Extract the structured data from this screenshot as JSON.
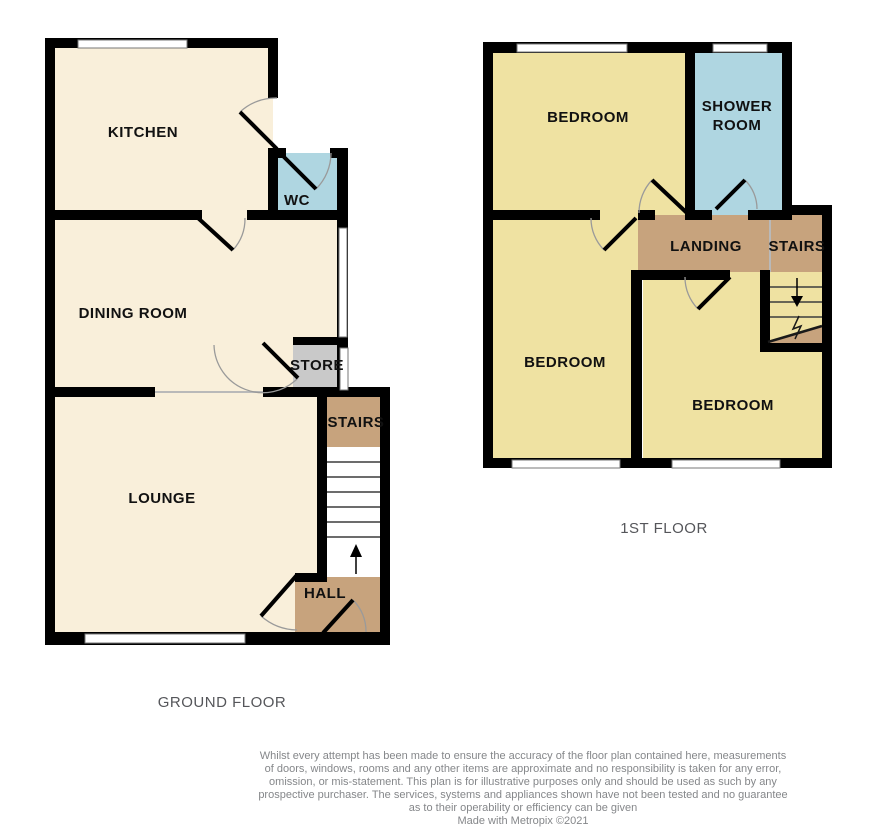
{
  "ground_floor": {
    "label": "GROUND FLOOR",
    "rooms": {
      "kitchen": "KITCHEN",
      "wc": "WC",
      "dining_room": "DINING ROOM",
      "store": "STORE",
      "stairs": "STAIRS",
      "lounge": "LOUNGE",
      "hall": "HALL"
    }
  },
  "first_floor": {
    "label": "1ST FLOOR",
    "rooms": {
      "bedroom_top": "BEDROOM",
      "shower_room_line1": "SHOWER",
      "shower_room_line2": "ROOM",
      "landing": "LANDING",
      "stairs": "STAIRS",
      "bedroom_left": "BEDROOM",
      "bedroom_right": "BEDROOM"
    }
  },
  "footer": {
    "disclaimer_lines": [
      "Whilst every attempt has been made to ensure the accuracy of the floor plan contained here, measurements",
      "of doors, windows, rooms and any other items are approximate and no responsibility is taken for any error,",
      "omission, or mis-statement. This plan is for illustrative purposes only and should be used as such by any",
      "prospective purchaser. The services, systems and appliances shown have not been tested and no guarantee",
      "as to their operability or efficiency can be given"
    ],
    "credit": "Made with Metropix ©2021"
  },
  "colors": {
    "room_cream": "#F9EFDA",
    "room_yellow": "#EFE2A2",
    "room_blue": "#AFD6E1",
    "room_tan": "#C7A37D",
    "room_gray": "#C9C9C9",
    "wall": "#000000",
    "floor_label_text": "#55565A",
    "disclaimer_text": "#85878A"
  }
}
